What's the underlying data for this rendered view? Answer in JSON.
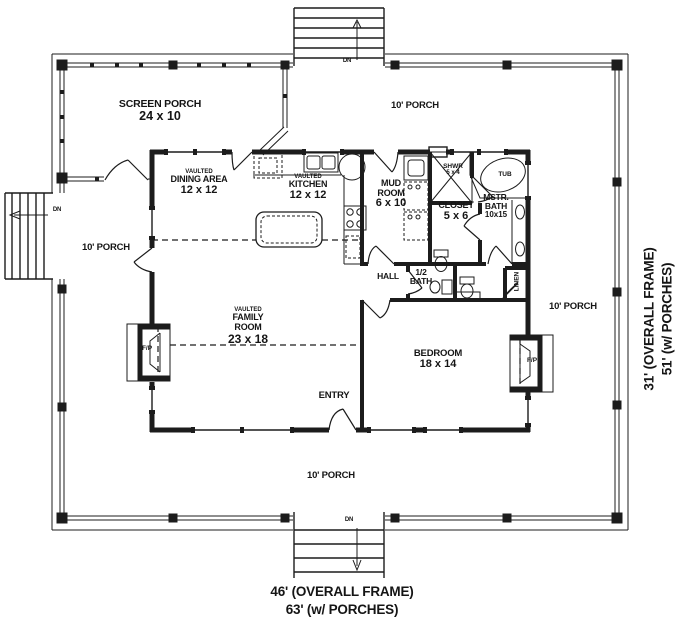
{
  "plan": {
    "rooms": {
      "screen_porch": {
        "name": "SCREEN PORCH",
        "size": "24 x 10"
      },
      "dining": {
        "prefix": "VAULTED",
        "name": "DINING AREA",
        "size": "12 x 12"
      },
      "kitchen": {
        "prefix": "VAULTED",
        "name": "KITCHEN",
        "size": "12 x 12"
      },
      "mud_room": {
        "name": "MUD ROOM",
        "size": "6 x 10"
      },
      "shower": {
        "name": "SHWR",
        "size": "5 x 4"
      },
      "tub": {
        "name": "TUB"
      },
      "closet": {
        "name": "CLOSET",
        "size": "5 x 6"
      },
      "master_bath": {
        "name": "MSTR. BATH",
        "size": "10x15"
      },
      "hall": {
        "name": "HALL"
      },
      "half_bath": {
        "name": "1/2 BATH"
      },
      "linen": {
        "name": "LINEN"
      },
      "family_room": {
        "prefix": "VAULTED",
        "name": "FAMILY ROOM",
        "size": "23 x 18"
      },
      "bedroom": {
        "name": "BEDROOM",
        "size": "18 x 14"
      },
      "entry": {
        "name": "ENTRY"
      }
    },
    "porch_labels": {
      "top": "10' PORCH",
      "left": "10' PORCH",
      "right": "10' PORCH",
      "bottom": "10' PORCH"
    },
    "fireplace_label": "F/P",
    "stairs_label": "DN",
    "dimensions": {
      "bottom_line1": "46' (OVERALL FRAME)",
      "bottom_line2": "63' (w/ PORCHES)",
      "right_line1": "31' (OVERALL FRAME)",
      "right_line2": "51' (w/ PORCHES)"
    },
    "colors": {
      "line": "#1c1c1c",
      "background": "#ffffff"
    }
  }
}
